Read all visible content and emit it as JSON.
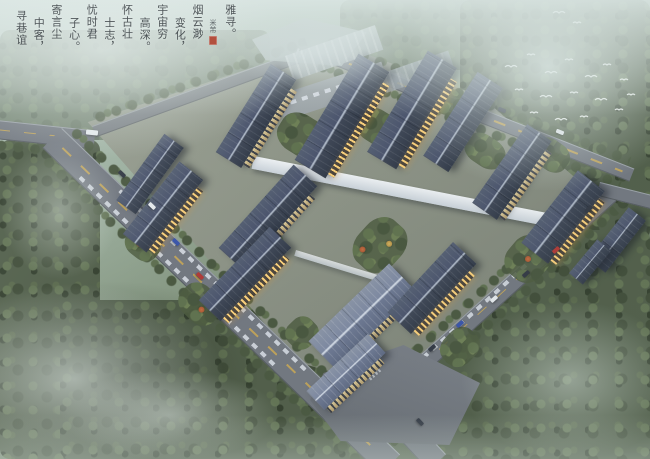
{
  "calligraphy": {
    "columns": [
      "雅寻。",
      "烟云渺",
      "变化，",
      "宇宙穷",
      "高深。",
      "怀古壮",
      "士志，",
      "忧时君",
      "子心。",
      "寄言尘",
      "中客，",
      "寻巷谊"
    ],
    "signature": "米芾",
    "seal_color": "#b03a27",
    "text_color": "#2b3136"
  },
  "palette": {
    "roof_dark": "#3b4453",
    "roof_light": "#77829a",
    "roof_ridge": "#aab4c4",
    "facade_cream": "#cdb88d",
    "window_glow": "#f2cc7d",
    "road_asphalt": "#6f747d",
    "road_centerline_yellow": "#d2ab4c",
    "podium_white": "#e7ebef",
    "forest_green": "#4b5844",
    "mist_white": "#dde9e5",
    "bird_white": "#ffffff"
  }
}
